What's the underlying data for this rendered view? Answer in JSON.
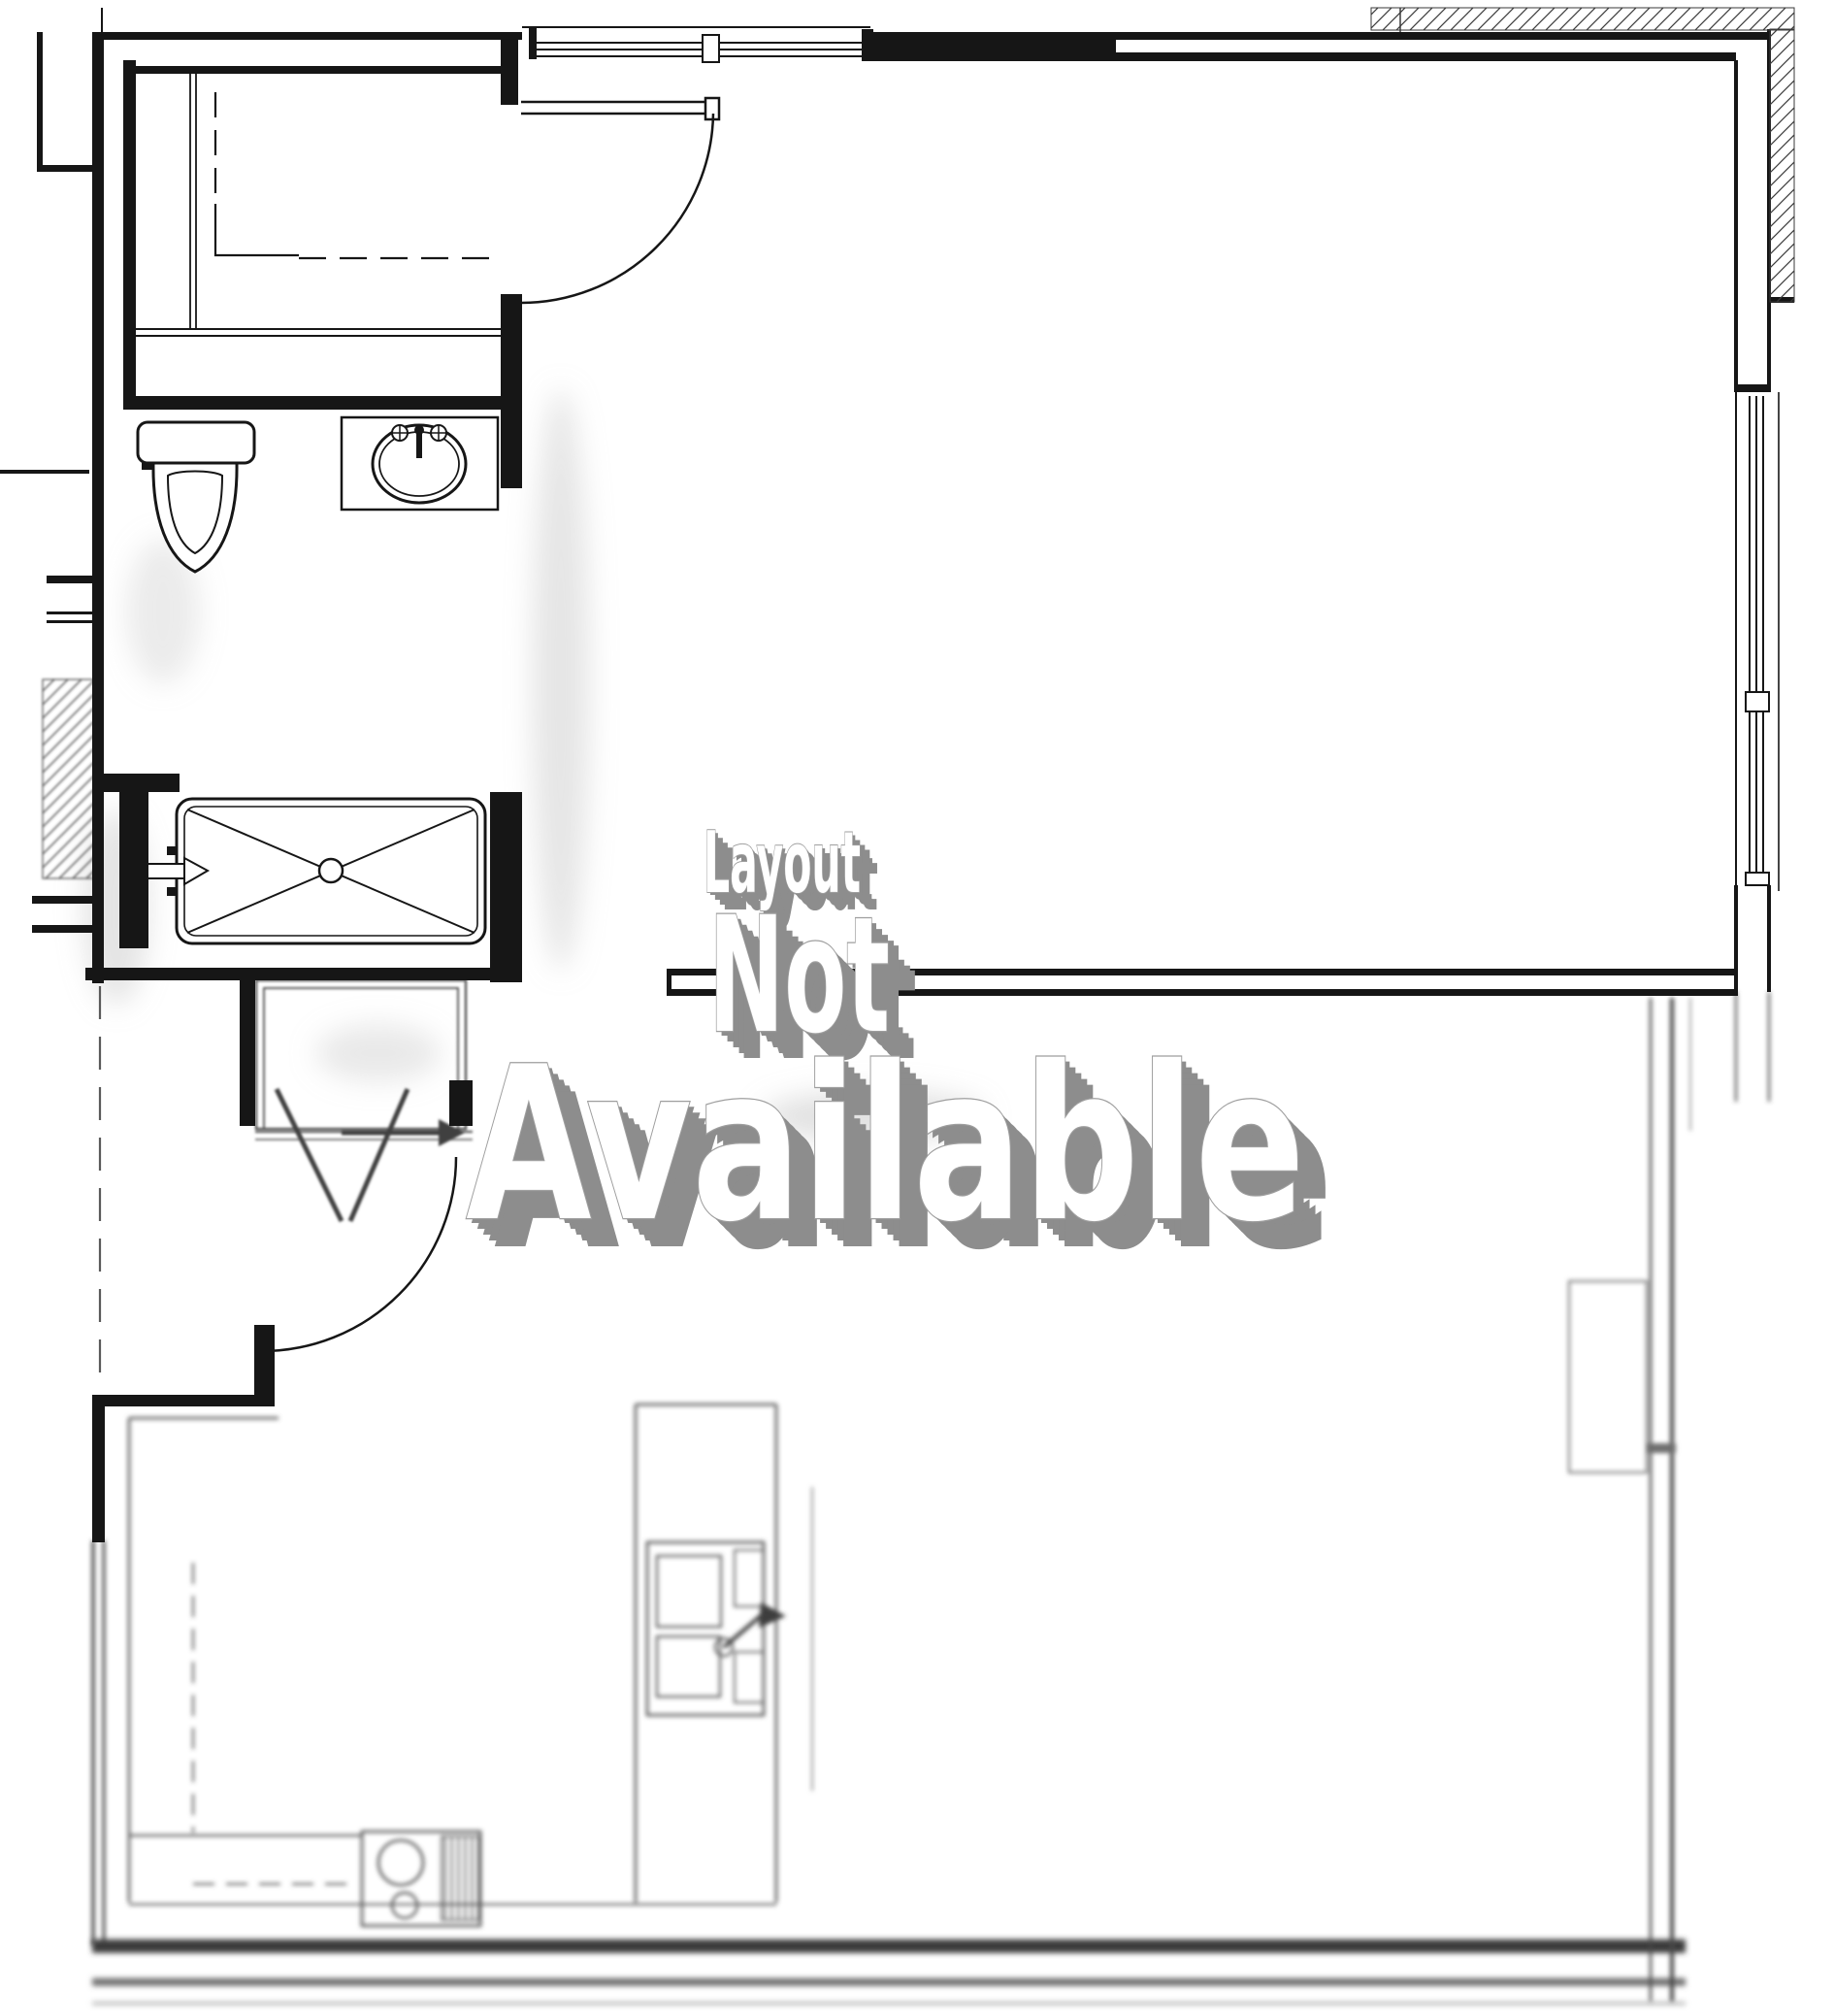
{
  "watermark": {
    "line1": "Layout",
    "line2": "Not",
    "line3": "Available",
    "text_color": "#ffffff",
    "extrude_color": "#8d8d8d",
    "outline_color": "#9e9e9e"
  },
  "plan": {
    "background": "#ffffff",
    "line_color": "#161616",
    "soft_line_color": "#555555",
    "features": [
      "closet-room",
      "closet-door",
      "bathroom",
      "toilet",
      "vanity-sink",
      "shower",
      "entry-vestibule",
      "entry-door",
      "living-room",
      "kitchen",
      "kitchen-sink",
      "stove",
      "top-window",
      "right-window",
      "hatched-exterior-wall"
    ]
  }
}
